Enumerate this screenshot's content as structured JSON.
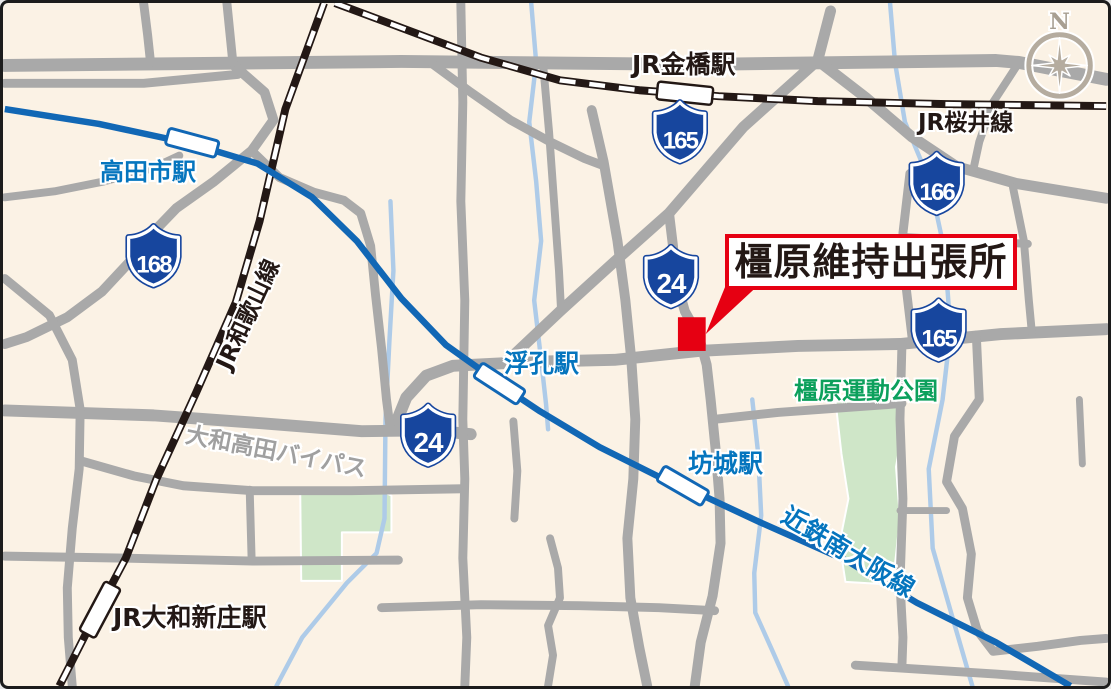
{
  "map": {
    "colors": {
      "bg": "#FBF2E5",
      "road": "#A9A9A9",
      "rail": "#231815",
      "rail_dash": "#FFFFFF",
      "river": "#AECBE8",
      "kintetsu": "#1167B5",
      "park": "#CFE6C8",
      "shield": "#17469E",
      "red": "#E60012",
      "text_blue": "#0575BE",
      "text_black": "#231815",
      "text_gray": "#A0A0A0",
      "text_green": "#0CA05C",
      "compass": "#B5AC9F",
      "compass_text": "#A89F92"
    },
    "parks": [
      {
        "id": "park-kashihara-sports",
        "d": "M838,402 L906,402 906,428 899,468 903,520 898,566 882,586 848,584 842,545 851,500 844,455 Z"
      },
      {
        "id": "park-southwest",
        "d": "M298,495 L380,492 390,497 390,534 340,534 340,583 299,583 Z"
      }
    ],
    "rivers": [
      {
        "id": "river-east",
        "d": "M893,0 L898,60 908,120 933,180 948,250 954,330 946,400 932,470 936,550 956,620 976,689",
        "w": 4.5
      },
      {
        "id": "river-center-north",
        "d": "M531,0 L536,60 529,120 536,180 541,240 534,300 541,360 546,405 548,430",
        "w": 4.5
      },
      {
        "id": "river-center-south",
        "d": "M754,400 L760,455 763,517 756,575 757,615 775,655 790,689",
        "w": 4.5
      },
      {
        "id": "river-west",
        "d": "M389,200 L392,270 388,340 384,420 383,520 375,555 345,585 300,640 274,689",
        "w": 4.5
      }
    ],
    "roads": [
      {
        "id": "road-top-main",
        "d": "M0,63 L400,59 700,62 1000,58 1023,60 1111,77",
        "w": 13
      },
      {
        "id": "road-top-left-parallel",
        "d": "M0,81 L140,81 235,72",
        "w": 9
      },
      {
        "id": "road-diagonal-165",
        "d": "M833,8 L820,58 745,125 670,212 615,261 560,311 505,363",
        "w": 11
      },
      {
        "id": "road-route24-city",
        "d": "M670,212 L674,245 676,276 686,311 700,336 708,365 712,400 717,450 721,500 722,545 714,598 702,645 696,689",
        "w": 10
      },
      {
        "id": "road-route166",
        "d": "M820,58 L868,95 915,135 960,165 1020,182 1111,197",
        "w": 11
      },
      {
        "id": "road-mid-horizontal",
        "d": "M392,430 L405,398 425,376 452,366 530,362 615,360 700,351 800,346 903,344 1005,334 1111,329",
        "w": 12
      },
      {
        "id": "road-bypass",
        "d": "M0,411 L150,416 260,424 360,432 430,431 470,435",
        "w": 12
      },
      {
        "id": "road-bypass-feeder",
        "d": "M249,149 L277,176 312,191 342,199 359,212 369,245 374,295 380,348 385,400 389,431",
        "w": 9
      },
      {
        "id": "road-route168",
        "d": "M230,62 L262,90 271,118 249,149 211,180 173,207 149,232 126,261 98,291 63,317 22,337 0,344",
        "w": 10
      },
      {
        "id": "road-top-stub-a",
        "d": "M224,0 L227,30 230,60",
        "w": 9
      },
      {
        "id": "road-top-stub-b",
        "d": "M140,0 L144,32 147,60",
        "w": 9
      },
      {
        "id": "road-left-connector",
        "d": "M0,196 L50,190 100,180 148,167 176,154",
        "w": 8
      },
      {
        "id": "road-left-vertical",
        "d": "M0,278 L45,315 68,360 76,410 75,470 68,530 63,590 64,640 68,689",
        "w": 9
      },
      {
        "id": "road-southwest-link",
        "d": "M77,462 L130,477 180,487 250,492 350,492 462,490",
        "w": 9
      },
      {
        "id": "road-southwest-jog",
        "d": "M247,491 L249,563",
        "w": 8
      },
      {
        "id": "road-south-left-horizontal",
        "d": "M0,558 L120,560 250,563 397,562",
        "w": 9
      },
      {
        "id": "road-center-vertical",
        "d": "M460,0 L462,100 460,200 464,300 462,420 464,480 462,560 466,640 464,689",
        "w": 9
      },
      {
        "id": "road-center-stub",
        "d": "M513,422 L517,472 514,520",
        "w": 8
      },
      {
        "id": "road-center-vertical-b",
        "d": "M543,62 L549,130 554,200 559,270 561,308",
        "w": 8
      },
      {
        "id": "road-diagonal-feeder",
        "d": "M432,62 L470,90 510,118 550,140 585,157 601,163",
        "w": 9
      },
      {
        "id": "road-center-vertical-c",
        "d": "M592,108 L604,160 618,240 626,300 632,360 636,420 634,480 628,540 631,600 640,650 648,689",
        "w": 10
      },
      {
        "id": "road-south-wiggle",
        "d": "M550,540 L558,570 560,600 548,628 553,658 548,689",
        "w": 8
      },
      {
        "id": "road-south-horizontal",
        "d": "M380,610 L480,607 580,608 660,610 716,613",
        "w": 9
      },
      {
        "id": "road-southeast-horizontal",
        "d": "M858,668 L1000,677 1111,685",
        "w": 9
      },
      {
        "id": "road-east-vertical-a",
        "d": "M913,172 L906,232 909,285 916,344",
        "w": 9
      },
      {
        "id": "road-east-horizontal-a",
        "d": "M906,236 L1032,243",
        "w": 8
      },
      {
        "id": "road-east-vertical-b",
        "d": "M1017,186 L1028,240 1033,300 1036,332",
        "w": 8
      },
      {
        "id": "road-northeast-connector",
        "d": "M1023,60 L997,100 983,140 977,168",
        "w": 8
      },
      {
        "id": "road-park-north",
        "d": "M716,420 L780,413 850,408 905,404",
        "w": 9
      },
      {
        "id": "road-park-east",
        "d": "M905,344 L903,420 906,500 903,585 906,640 905,668",
        "w": 9
      },
      {
        "id": "road-southeast-wiggle",
        "d": "M980,335 L983,400 958,437 950,483 966,510 975,556 971,600 981,633 997,654 1042,649 1085,643 1111,641",
        "w": 9
      },
      {
        "id": "road-park-link",
        "d": "M903,512 L950,512",
        "w": 7
      },
      {
        "id": "road-east-stub",
        "d": "M1084,400 L1087,465",
        "w": 7
      }
    ],
    "railways": [
      {
        "id": "railway-jr-sakurai",
        "d": "M333,0 L400,25 480,55 560,78 640,88 720,94 820,99 950,102 1111,104"
      },
      {
        "id": "railway-jr-wakayama",
        "d": "M322,0 L283,107 257,220 233,302 193,393 153,480 122,560 85,630 55,689"
      }
    ],
    "kintetsu_line": {
      "id": "railway-kintetsu-minami-osaka",
      "d": "M0,107 L95,122 188,142 255,162 310,196 355,240 400,298 445,345 480,370 498,384 540,412 600,448 660,478 683,487 760,523 850,563 920,605 1000,645 1075,689",
      "w": 6.5
    },
    "stations": [
      {
        "id": "station-takadashi",
        "type": "kintetsu",
        "x": 189,
        "y": 141,
        "angle": 15,
        "w": 52,
        "h": 17
      },
      {
        "id": "station-ukiana",
        "type": "kintetsu",
        "x": 499,
        "y": 384,
        "angle": 33,
        "w": 52,
        "h": 17
      },
      {
        "id": "station-bojo",
        "type": "kintetsu",
        "x": 684,
        "y": 487,
        "angle": 30,
        "w": 52,
        "h": 17
      },
      {
        "id": "station-kanahashi",
        "type": "jr",
        "x": 686,
        "y": 91,
        "angle": 6,
        "w": 56,
        "h": 18
      },
      {
        "id": "station-yamato-shinjo",
        "type": "jr",
        "x": 96,
        "y": 612,
        "angle": -62,
        "w": 56,
        "h": 18
      }
    ],
    "shields": [
      {
        "num": "165",
        "x": 681,
        "y": 130
      },
      {
        "num": "166",
        "x": 940,
        "y": 182
      },
      {
        "num": "165",
        "x": 942,
        "y": 330
      },
      {
        "num": "168",
        "x": 150,
        "y": 255
      },
      {
        "num": "24",
        "x": 672,
        "y": 276
      },
      {
        "num": "24",
        "x": 427,
        "y": 436
      }
    ],
    "labels": [
      {
        "id": "label-takadashi-station",
        "text": "高田市駅",
        "x": 97,
        "y": 157,
        "size": 24,
        "color": "blue"
      },
      {
        "id": "label-kanahashi-station",
        "text": "JR金橋駅",
        "x": 629,
        "y": 49,
        "size": 25,
        "color": "black"
      },
      {
        "id": "label-jr-sakurai-line",
        "text": "JR桜井線",
        "x": 915,
        "y": 109,
        "size": 23,
        "color": "black"
      },
      {
        "id": "label-jr-wakayama-line",
        "text": "JR和歌山線",
        "x": 246,
        "y": 312,
        "size": 23,
        "color": "black",
        "rotate": -65,
        "centered": true
      },
      {
        "id": "label-ukiana-station",
        "text": "浮孔駅",
        "x": 501,
        "y": 348,
        "size": 25,
        "color": "blue"
      },
      {
        "id": "label-bojo-station",
        "text": "坊城駅",
        "x": 685,
        "y": 448,
        "size": 25,
        "color": "blue"
      },
      {
        "id": "label-yamato-shinjo-station",
        "text": "JR大和新庄駅",
        "x": 110,
        "y": 602,
        "size": 25,
        "color": "black"
      },
      {
        "id": "label-yamato-takada-bypass",
        "text": "大和高田バイパス",
        "x": 273,
        "y": 450,
        "size": 23,
        "color": "gray",
        "rotate": 11,
        "centered": true
      },
      {
        "id": "label-kintetsu-minami-osaka-line",
        "text": "近鉄南大阪線",
        "x": 845,
        "y": 549,
        "size": 25,
        "color": "blue",
        "rotate": 31,
        "centered": true
      },
      {
        "id": "label-kashihara-sports-park",
        "text": "橿原運動公園",
        "x": 791,
        "y": 376,
        "size": 24,
        "color": "green"
      }
    ],
    "marker": {
      "x": 679,
      "y": 317,
      "w": 28,
      "h": 34,
      "pointer": "728,283 762,283 707,334"
    },
    "callout": {
      "text": "橿原維持出張所",
      "x": 722,
      "y": 231,
      "w": 292,
      "h": 56,
      "font_size": 38
    },
    "compass": {
      "x": 1064,
      "y": 63,
      "r": 31,
      "r_long": 28,
      "r_diag": 15,
      "r_valley": 6.5,
      "n_label": "N",
      "n_x": 1064,
      "n_y": 18
    }
  }
}
